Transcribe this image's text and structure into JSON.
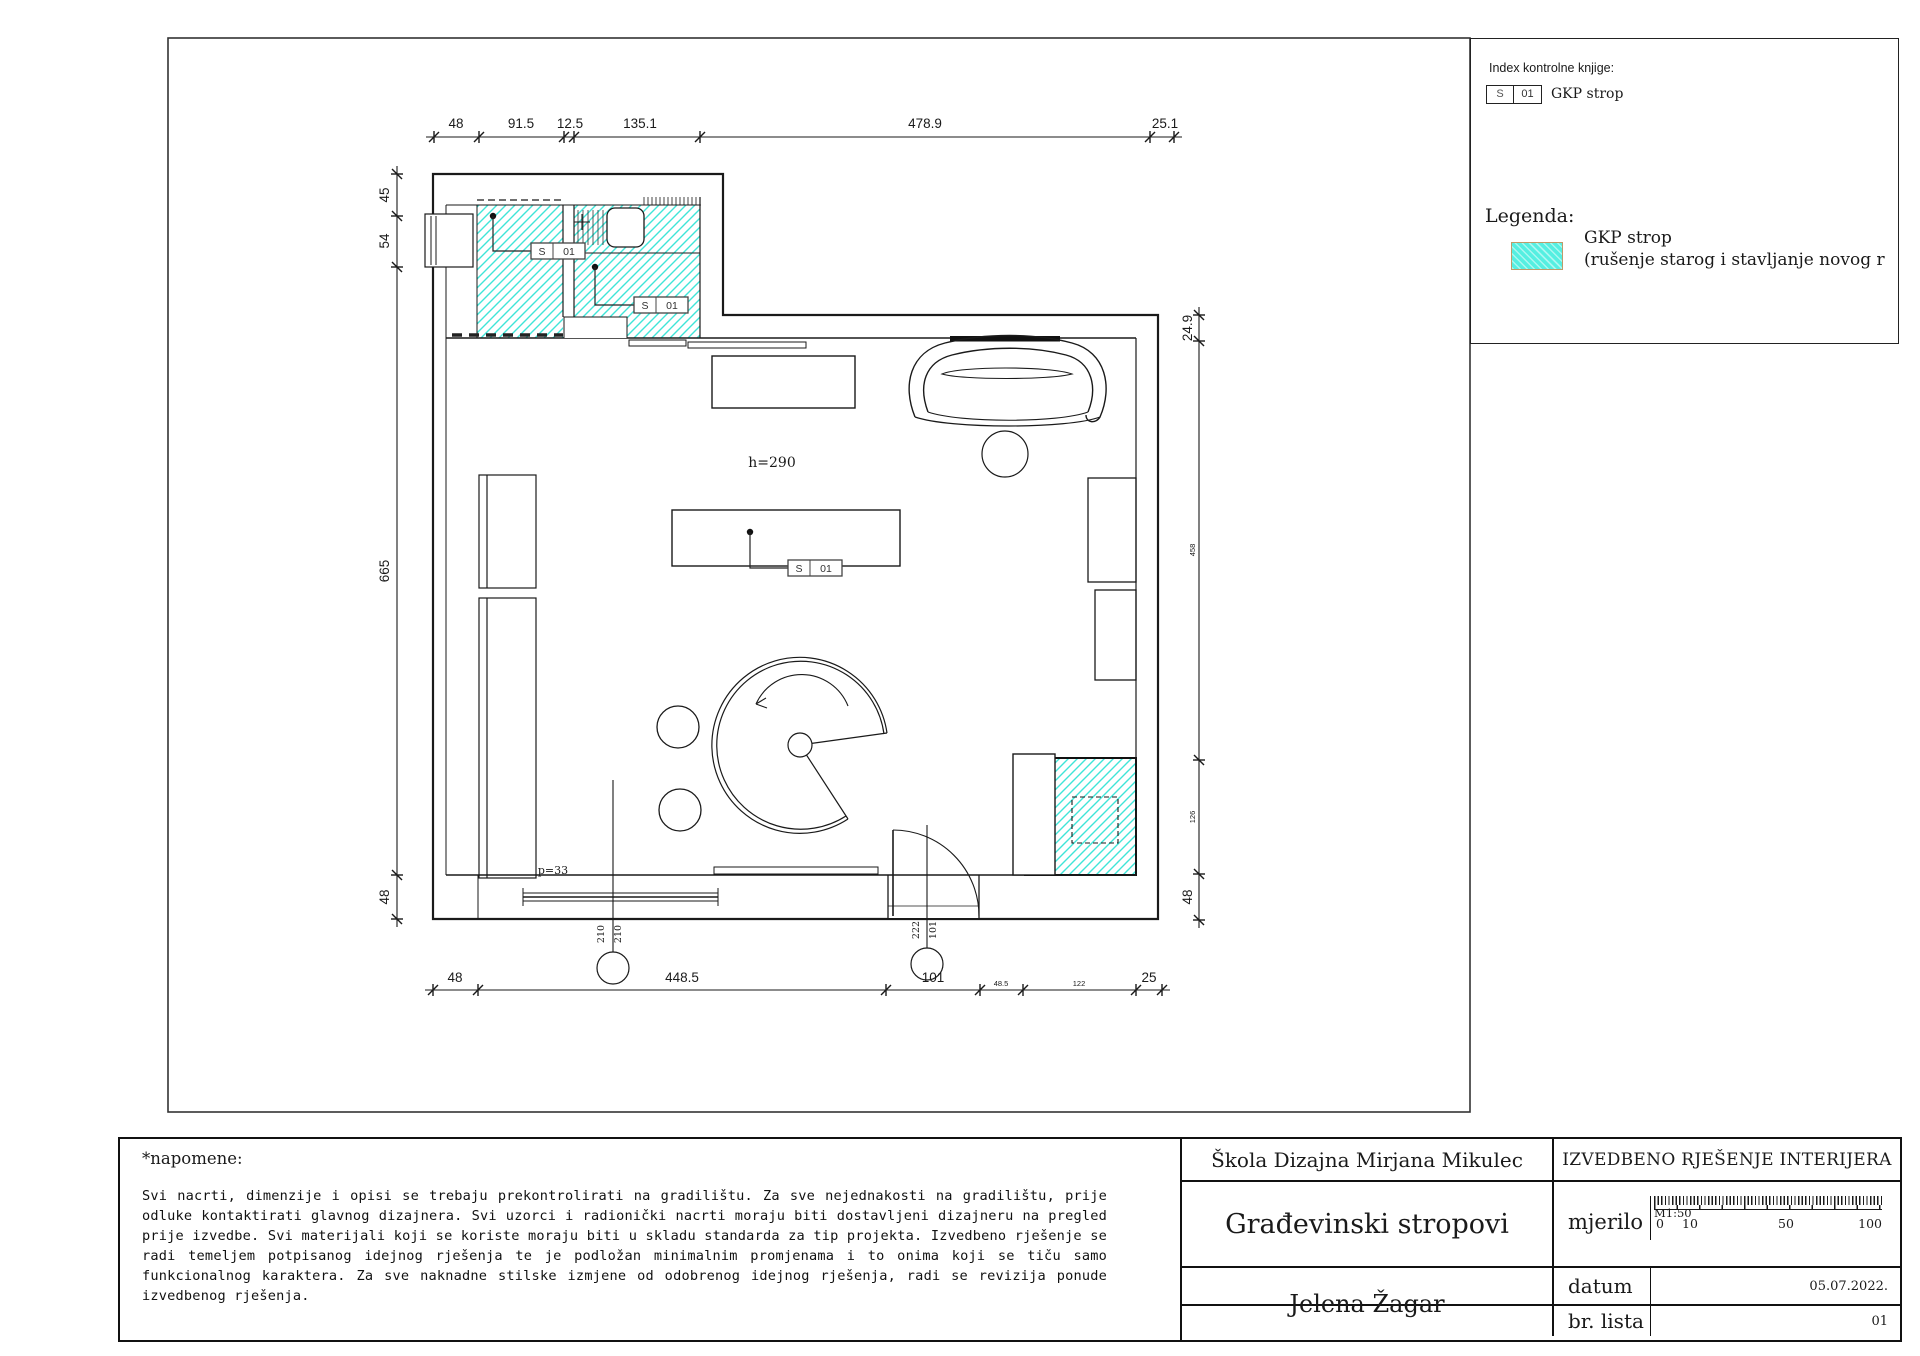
{
  "legend_box": {
    "index_label": "Index kontrolne knjige:",
    "index_tag": {
      "s": "S",
      "num": "01"
    },
    "index_name": "GKP strop",
    "legenda_label": "Legenda:",
    "item_title": "GKP strop",
    "item_desc": "(rušenje starog i stavljanje novog r",
    "swatch_color": "#55efe1"
  },
  "plan": {
    "room_height_label": "h=290",
    "floor_label": "p=33",
    "tag": {
      "s": "S",
      "num": "01"
    },
    "callout_left": {
      "a": "210",
      "b": "210"
    },
    "callout_right": {
      "a": "222",
      "b": "101"
    },
    "dims": {
      "top": [
        "48",
        "91.5",
        "12.5",
        "135.1",
        "478.9",
        "25.1"
      ],
      "left": [
        "45",
        "54",
        "665",
        "48"
      ],
      "right": [
        "24.9",
        "458",
        "126",
        "48"
      ],
      "bottom": [
        "48",
        "448.5",
        "101",
        "48.5",
        "122",
        "25"
      ]
    }
  },
  "notes": {
    "heading": "*napomene:",
    "body": "Svi nacrti, dimenzije i opisi se trebaju prekontrolirati na gradilištu. Za sve nejednakosti na gradilištu, prije odluke kontaktirati glavnog dizajnera. Svi uzorci i radionički nacrti moraju biti dostavljeni dizajneru na pregled prije izvedbe. Svi materijali koji se koriste moraju biti u skladu standarda za tip projekta. Izvedbeno rješenje se radi temeljem potpisanog idejnog rješenja te je podložan minimalnim promjenama i to onima koji se tiču samo funkcionalnog karaktera. Za sve naknadne stilske izmjene od odobrenog idejnog rješenja, radi se revizija ponude izvedbenog rješenja."
  },
  "titleblock": {
    "school": "Škola Dizajna Mirjana Mikulec",
    "project_type": "IZVEDBENO RJEŠENJE INTERIJERA",
    "sheet_title": "Građevinski stropovi",
    "author": "Jelena Žagar",
    "scale_label": "mjerilo",
    "scale_value": "M1:50",
    "ruler_ticks": [
      "0",
      "10",
      "50",
      "100"
    ],
    "date_label": "datum",
    "date_value": "05.07.2022.",
    "sheet_label": "br. lista",
    "sheet_value": "01"
  },
  "colors": {
    "hatch": "#3fe5d8",
    "swatch_border": "#bf9b6a",
    "line": "#1a1a1a"
  }
}
